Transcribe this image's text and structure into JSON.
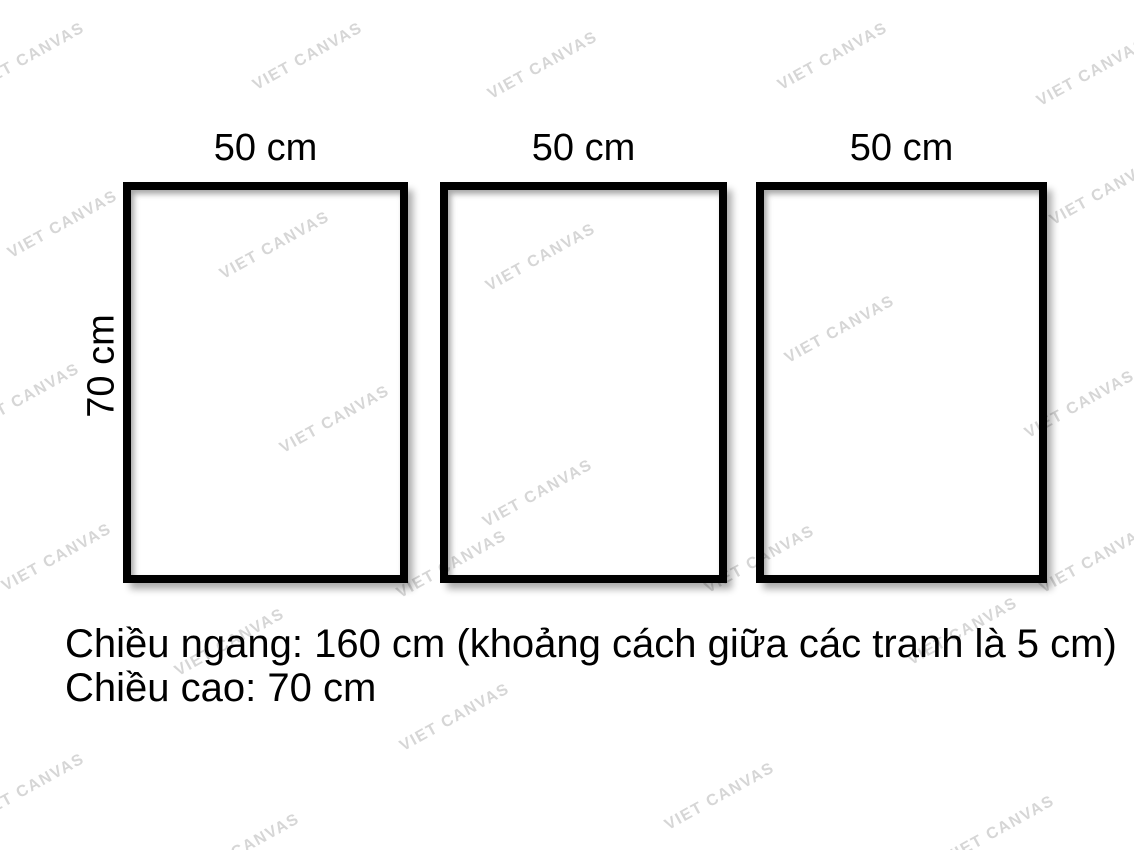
{
  "watermark": {
    "text": "VIET CANVAS",
    "color": "#d6d6d6",
    "positions": [
      [
        30,
        57
      ],
      [
        308,
        57
      ],
      [
        543,
        66
      ],
      [
        833,
        57
      ],
      [
        1092,
        73
      ],
      [
        1105,
        192
      ],
      [
        63,
        225
      ],
      [
        275,
        246
      ],
      [
        541,
        258
      ],
      [
        840,
        330
      ],
      [
        25,
        398
      ],
      [
        335,
        420
      ],
      [
        1080,
        405
      ],
      [
        57,
        558
      ],
      [
        452,
        565
      ],
      [
        538,
        494
      ],
      [
        760,
        560
      ],
      [
        1095,
        560
      ],
      [
        230,
        643
      ],
      [
        963,
        632
      ],
      [
        455,
        718
      ],
      [
        30,
        788
      ],
      [
        720,
        797
      ],
      [
        1000,
        830
      ],
      [
        245,
        848
      ]
    ]
  },
  "frames": [
    {
      "width_label": "50 cm"
    },
    {
      "width_label": "50 cm"
    },
    {
      "width_label": "50 cm"
    }
  ],
  "height_label": "70 cm",
  "caption": {
    "line1": "Chiều ngang: 160 cm (khoảng cách giữa các tranh là 5 cm)",
    "line2": "Chiều cao: 70 cm"
  }
}
